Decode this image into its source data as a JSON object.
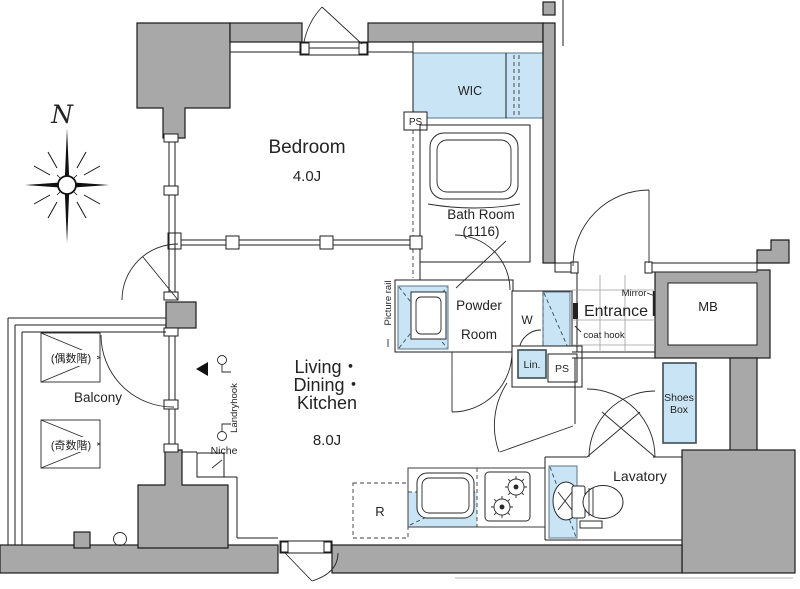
{
  "colors": {
    "wall_fill": "#a8a8a8",
    "outline": "#1c1c1c",
    "highlight": "#c9e4f4",
    "highlight_stroke": "#5b7689",
    "label": "#232323"
  },
  "compass": {
    "north_label": "N"
  },
  "rooms": {
    "bedroom": {
      "name": "Bedroom",
      "size": "4.0J"
    },
    "wic": {
      "name": "WIC"
    },
    "bath": {
      "name": "Bath Room",
      "size": "(1116)"
    },
    "powder": {
      "line1": "Powder",
      "line2": "Room"
    },
    "entrance": {
      "name": "Entrance"
    },
    "ldk": {
      "line1": "Living・",
      "line2": "Dining・",
      "line3": "Kitchen",
      "size": "8.0J"
    },
    "lavatory": {
      "name": "Lavatory"
    },
    "balcony": {
      "name": "Balcony",
      "even_floor": "(偶数階)",
      "odd_floor": "(奇数階)"
    },
    "meter_box": {
      "name": "MB"
    }
  },
  "fixtures": {
    "pipe_space_upper": "PS",
    "pipe_space_lower": "PS",
    "washer": "W",
    "linen": "Lin.",
    "shoes_box_line1": "Shoes",
    "shoes_box_line2": "Box",
    "refrigerator": "R",
    "niche": "Niche",
    "laundry_hook": "Landryhook",
    "picture_rail": "Picture rail",
    "mirror": "Mirror",
    "coat_hook": "coat hook"
  }
}
